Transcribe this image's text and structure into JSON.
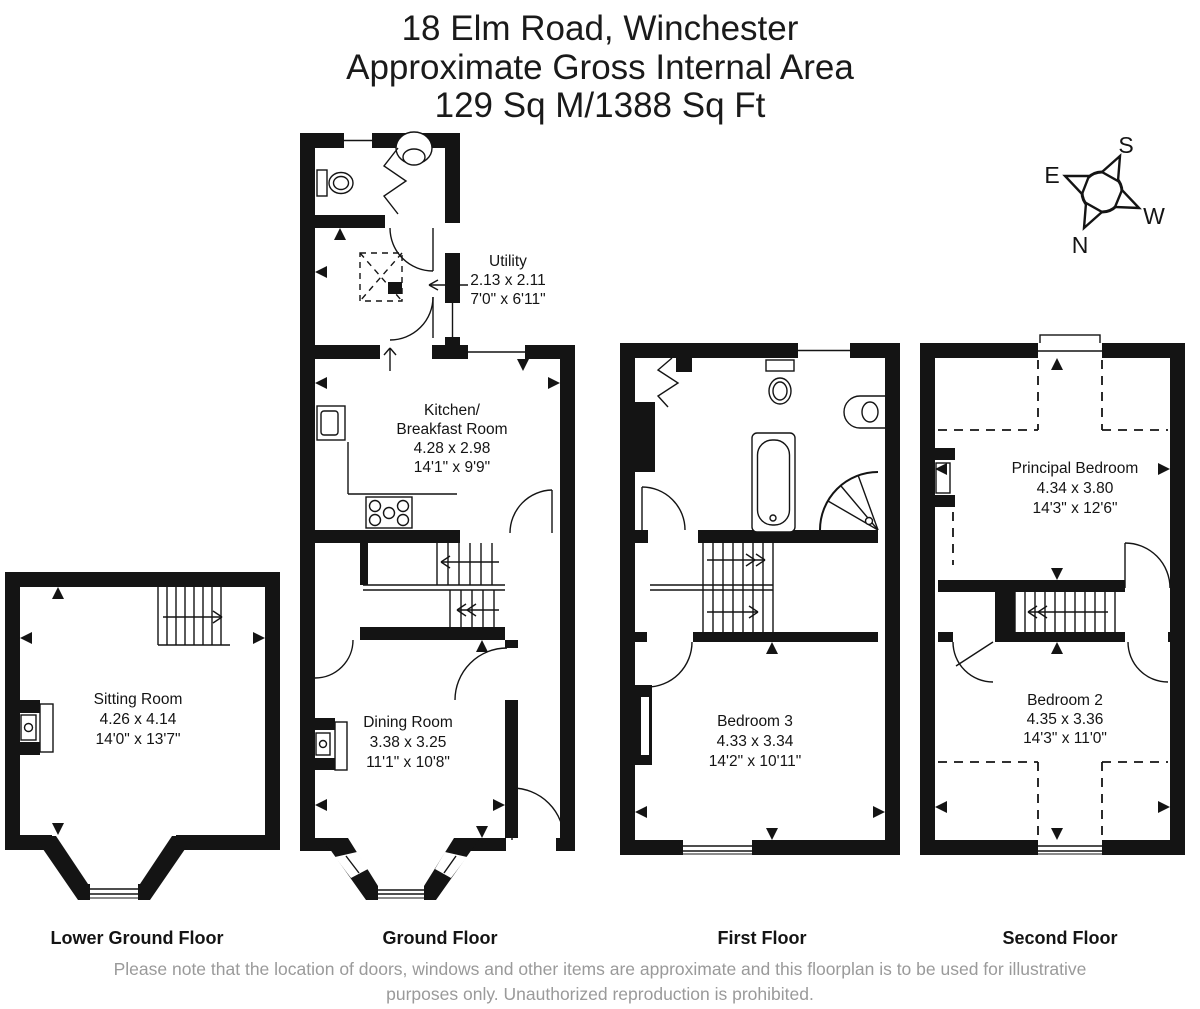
{
  "title": {
    "line1": "18 Elm Road, Winchester",
    "line2": "Approximate Gross Internal Area",
    "line3": "129 Sq M/1388 Sq Ft"
  },
  "compass": {
    "north": "N",
    "south": "S",
    "east": "E",
    "west": "W"
  },
  "floors": {
    "lower_ground": {
      "label": "Lower Ground Floor",
      "rooms": {
        "sitting_room": {
          "name": "Sitting Room",
          "metric": "4.26 x 4.14",
          "imperial": "14'0\" x 13'7\""
        }
      }
    },
    "ground": {
      "label": "Ground Floor",
      "rooms": {
        "utility": {
          "name": "Utility",
          "metric": "2.13 x 2.11",
          "imperial": "7'0\" x 6'11\""
        },
        "kitchen": {
          "name_line1": "Kitchen/",
          "name_line2": "Breakfast Room",
          "metric": "4.28 x 2.98",
          "imperial": "14'1\" x 9'9\""
        },
        "dining_room": {
          "name": "Dining Room",
          "metric": "3.38 x 3.25",
          "imperial": "11'1\" x 10'8\""
        }
      }
    },
    "first": {
      "label": "First Floor",
      "rooms": {
        "bedroom_3": {
          "name": "Bedroom 3",
          "metric": "4.33 x 3.34",
          "imperial": "14'2\" x 10'11\""
        }
      }
    },
    "second": {
      "label": "Second Floor",
      "rooms": {
        "principal_bedroom": {
          "name": "Principal Bedroom",
          "metric": "4.34 x 3.80",
          "imperial": "14'3\" x 12'6\""
        },
        "bedroom_2": {
          "name": "Bedroom 2",
          "metric": "4.35 x 3.36",
          "imperial": "14'3\" x 11'0\""
        }
      }
    }
  },
  "footer": {
    "line1": "Please note that the location of doors, windows and other items are approximate and this floorplan is to be used for illustrative",
    "line2": "purposes only. Unauthorized reproduction is prohibited."
  },
  "colors": {
    "wall": "#141414",
    "note_text": "#9a9a9a"
  }
}
